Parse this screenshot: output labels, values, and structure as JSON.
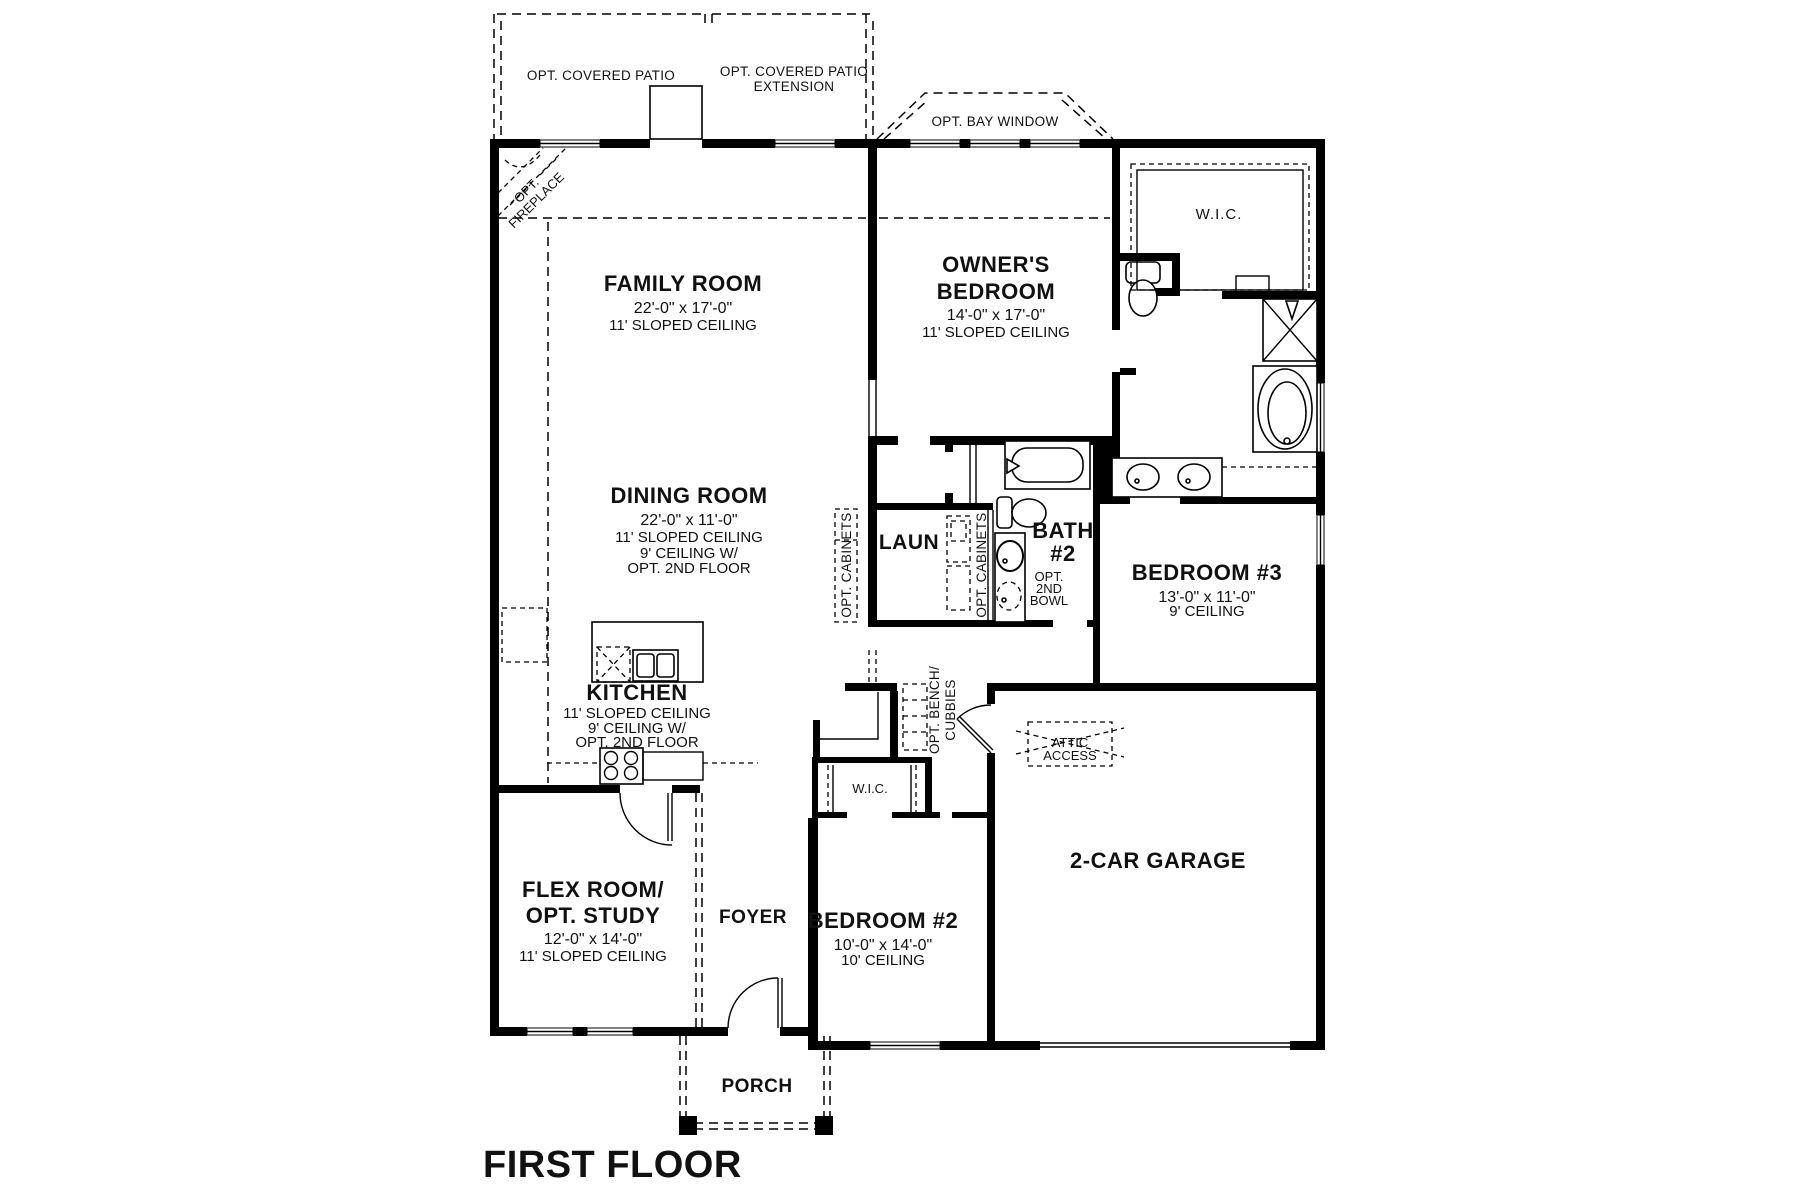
{
  "plan": {
    "title": "FIRST FLOOR"
  },
  "options": {
    "covered_patio": "OPT. COVERED PATIO",
    "covered_patio_ext_line1": "OPT. COVERED PATIO",
    "covered_patio_ext_line2": "EXTENSION",
    "bay_window": "OPT. BAY WINDOW",
    "fireplace_line1": "OPT.",
    "fireplace_line2": "FIREPLACE",
    "cabinets_left": "OPT. CABINETS",
    "cabinets_right": "OPT. CABINETS",
    "bench_line1": "OPT. BENCH/",
    "bench_line2": "CUBBIES",
    "second_bowl_line1": "OPT.",
    "second_bowl_line2": "2ND",
    "second_bowl_line3": "BOWL",
    "attic_line1": "ATTIC",
    "attic_line2": "ACCESS"
  },
  "rooms": {
    "family": {
      "name": "FAMILY ROOM",
      "dims": "22'-0\" x 17'-0\"",
      "ceiling": "11' SLOPED CEILING"
    },
    "owners": {
      "name_line1": "OWNER'S",
      "name_line2": "BEDROOM",
      "dims": "14'-0\" x 17'-0\"",
      "ceiling": "11' SLOPED CEILING"
    },
    "wic_owner": {
      "name": "W.I.C."
    },
    "dining": {
      "name": "DINING ROOM",
      "dims": "22'-0\" x 11'-0\"",
      "ceiling_line1": "11' SLOPED CEILING",
      "ceiling_line2": "9' CEILING W/",
      "ceiling_line3": "OPT. 2ND FLOOR"
    },
    "laundry": {
      "name": "LAUN"
    },
    "bath2": {
      "name_line1": "BATH",
      "name_line2": "#2"
    },
    "bedroom3": {
      "name": "BEDROOM #3",
      "dims": "13'-0\" x 11'-0\"",
      "ceiling": "9' CEILING"
    },
    "kitchen": {
      "name": "KITCHEN",
      "ceiling_line1": "11' SLOPED CEILING",
      "ceiling_line2": "9' CEILING W/",
      "ceiling_line3": "OPT. 2ND FLOOR"
    },
    "garage": {
      "name": "2-CAR GARAGE"
    },
    "wic_bedroom2": {
      "name": "W.I.C."
    },
    "flex": {
      "name_line1": "FLEX ROOM/",
      "name_line2": "OPT. STUDY",
      "dims": "12'-0\" x 14'-0\"",
      "ceiling": "11' SLOPED CEILING"
    },
    "foyer": {
      "name": "FOYER"
    },
    "bedroom2": {
      "name": "BEDROOM #2",
      "dims": "10'-0\" x 14'-0\"",
      "ceiling": "10' CEILING"
    },
    "porch": {
      "name": "PORCH"
    }
  }
}
